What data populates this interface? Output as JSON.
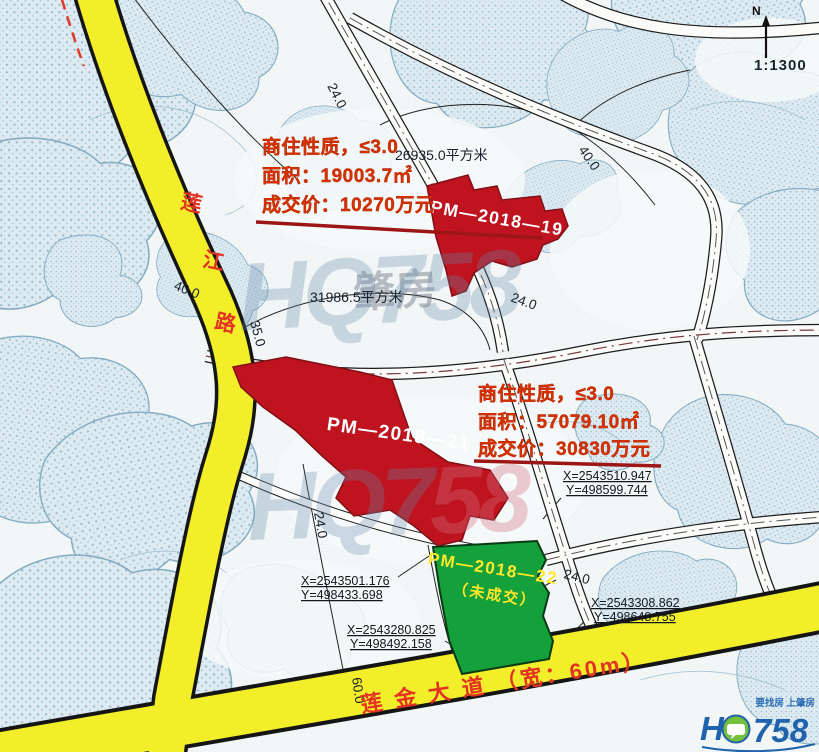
{
  "scale": "1:1300",
  "north": "N",
  "roads": {
    "lianjiang_chars": [
      "莲",
      "江",
      "路"
    ],
    "lianjin_label": "莲 金 大 道 （宽：60m）"
  },
  "parcels": {
    "p19": {
      "id": "PM—2018—19"
    },
    "p21": {
      "id": "PM—2018—21"
    },
    "p22": {
      "id": "PM—2018—22",
      "status": "（未成交）"
    }
  },
  "annotations": {
    "block1": {
      "line1": "商住性质，≤3.0",
      "line2": "面积：19003.7㎡",
      "line3": "成交价：10270万元"
    },
    "block2": {
      "line1": "商住性质，≤3.0",
      "line2": "面积：57079.10㎡",
      "line3": "成交价：30830万元"
    }
  },
  "area_labels": {
    "a1": "26935.0平方米",
    "a2": "31986.5平方米"
  },
  "coordinates": {
    "c1": {
      "x": "X=2543510.947",
      "y": "Y=498599.744"
    },
    "c2": {
      "x": "X=2543501.176",
      "y": "Y=498433.698"
    },
    "c3": {
      "x": "X=2543280.825",
      "y": "Y=498492.158"
    },
    "c4": {
      "x": "X=2543308.862",
      "y": "Y=498648.755"
    }
  },
  "dimensions": {
    "d1": "24.0",
    "d2": "40.0",
    "d3": "40.0",
    "d4": "35.0",
    "d5": "24.0",
    "d6": "24.0",
    "d7": "60.0",
    "d8": "24.0"
  },
  "watermark": {
    "brand": "HQ758",
    "brand_a": "HQ7",
    "brand_b": "58",
    "cn": "肇房"
  },
  "logo": {
    "tagline": "要找房 上肇房",
    "h": "H",
    "num": "758"
  },
  "colors": {
    "parcel_red": "#bf1420",
    "parcel_green": "#14a03a",
    "road_yellow": "#f2ee2a",
    "annotation_red": "#d43000",
    "underline_red": "#9c1616"
  }
}
